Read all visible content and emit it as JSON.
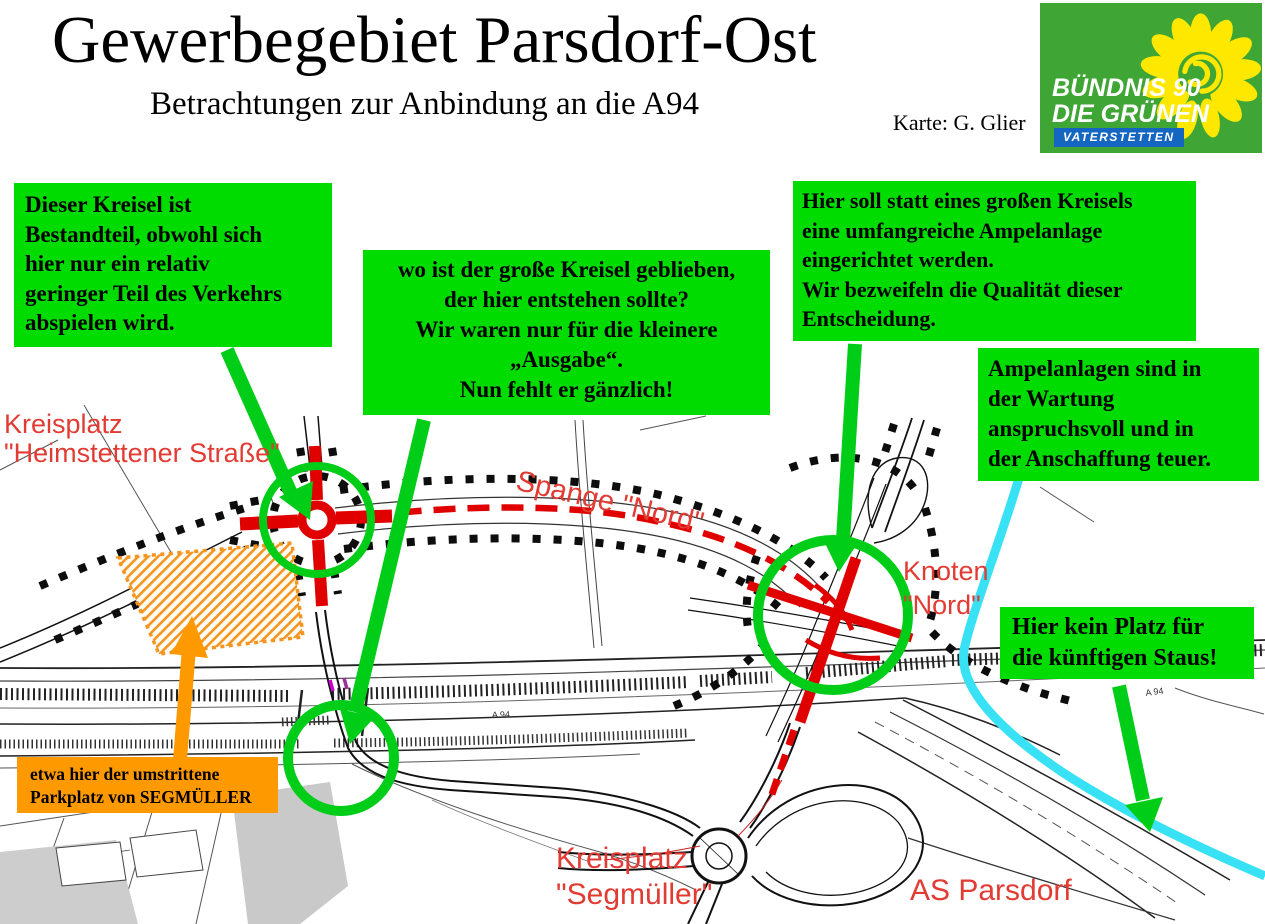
{
  "title": "Gewerbegebiet Parsdorf-Ost",
  "subtitle": "Betrachtungen zur Anbindung an die A94",
  "credit": "Karte: G. Glier",
  "logo": {
    "line1": "BÜNDNIS 90\nDIE GRÜNEN",
    "banner": "VATERSTETTEN",
    "bg_green": "#3fa535",
    "banner_blue": "#1566c0",
    "sunflower_yellow": "#ffe800"
  },
  "colors": {
    "note_green": "#00dc00",
    "annotation_green": "#00cd18",
    "orange": "#ff9900",
    "road_red": "#e00000",
    "label_red": "#e23b33",
    "congestion_cyan": "#38e2f4"
  },
  "notes": [
    {
      "text": "Dieser Kreisel ist\nBestandteil, obwohl sich\nhier nur ein relativ\ngeringer Teil des Verkehrs\nabspielen wird."
    },
    {
      "text": "wo ist der große Kreisel geblieben,\nder hier entstehen sollte?\nWir waren nur für die kleinere\n„Ausgabe“.\nNun fehlt er gänzlich!"
    },
    {
      "text": "Hier soll statt eines großen Kreisels\neine umfangreiche Ampelanlage\neingerichtet werden.\nWir bezweifeln die Qualität dieser\nEntscheidung."
    },
    {
      "text": "Ampelanlagen sind in\nder Wartung\nanspruchsvoll und in\nder Anschaffung teuer."
    },
    {
      "text": "Hier kein Platz für\ndie künftigen Staus!"
    },
    {
      "text": "etwa hier der umstrittene\nParkplatz von SEGMÜLLER"
    }
  ],
  "map_labels": [
    {
      "text": "Kreisplatz\n\"Heimstettener Straße\""
    },
    {
      "text": "Spange \"Nord\""
    },
    {
      "text": "Knoten\n\"Nord\""
    },
    {
      "text": "Kreisplatz\n\"Segmüller\""
    },
    {
      "text": "AS Parsdorf"
    },
    {
      "text": "A 94"
    },
    {
      "text": "A 94"
    }
  ]
}
